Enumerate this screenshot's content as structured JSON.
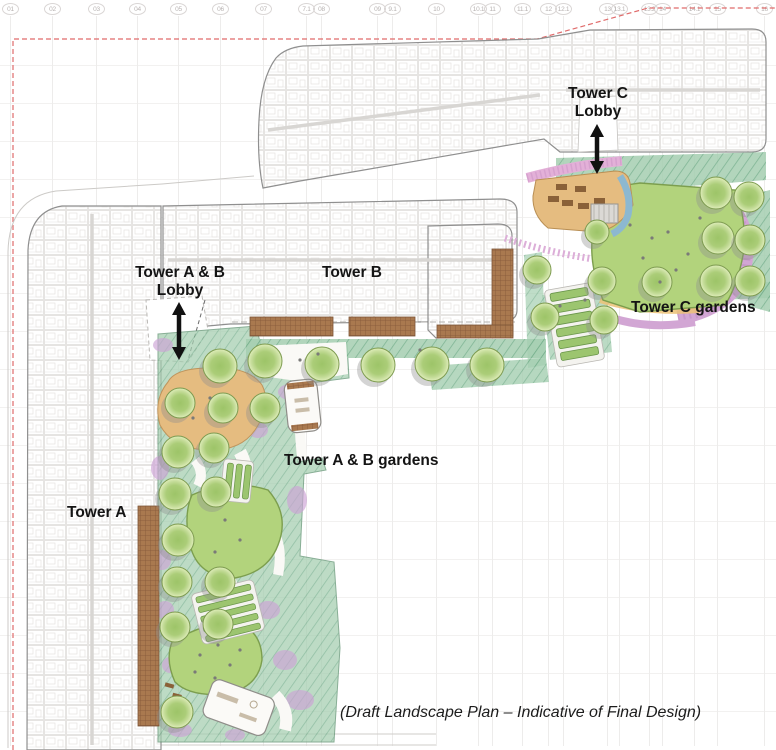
{
  "grid": {
    "labels": [
      "01",
      "02",
      "03",
      "04",
      "05",
      "06",
      "07",
      "7.1",
      "08",
      "09",
      "9.1",
      "10",
      "10.1",
      "11",
      "11.1",
      "12",
      "12.1",
      "13",
      "13.1",
      "13.2",
      "14",
      "14.1",
      "15",
      "16"
    ]
  },
  "labels": {
    "tower_c_lobby": {
      "line1": "Tower C",
      "line2": "Lobby"
    },
    "tower_ab_lobby": {
      "line1": "Tower A & B",
      "line2": "Lobby"
    },
    "tower_b": "Tower B",
    "tower_c_gardens": "Tower C gardens",
    "tower_ab_gardens": "Tower A & B gardens",
    "tower_a": "Tower A"
  },
  "caption": "(Draft Landscape Plan – Indicative of Final Design)",
  "icons": {
    "lobby_connector": "double-headed-vertical-arrow",
    "tree": "round-tree-canopy"
  },
  "palette": {
    "background": "#ffffff",
    "grid_line": "#edeceb",
    "grid_text": "#b7b2b1",
    "boundary_red": "#e06b6b",
    "building_line": "#8f8f8f",
    "lawn_green": "#b2d37c",
    "lawn_edge": "#7c9e4e",
    "tree_edge": "#7d9b50",
    "hatch_green": "#a4ceb0",
    "planting_purple": "#cda3d6",
    "planting_pink": "#e3b0d8",
    "deck_brown": "#a9794f",
    "play_sand": "#e5bc80",
    "water_blue": "#8cb8d0",
    "path_white": "#faf9f6",
    "label_color": "#141414",
    "arrow_black": "#111111"
  }
}
